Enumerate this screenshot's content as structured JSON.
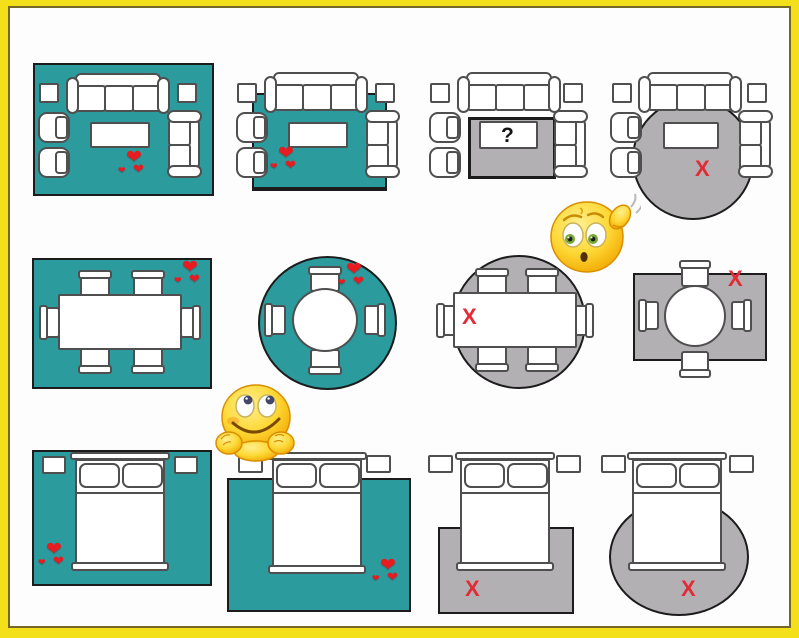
{
  "title": "rug-size-and-placement-guide",
  "marks": {
    "heart": "❤",
    "x": "X",
    "question": "?"
  },
  "colors": {
    "frame_yellow": "#f4e01a",
    "frame_inner_line": "#756827",
    "background": "#fdfdfd",
    "rug_correct_teal": "#2b9b9d",
    "rug_wrong_gray": "#b3b0b3",
    "furniture_outline": "#4f4f4f",
    "rug_outline": "#1c1c1c",
    "heart_red": "#e81c20",
    "x_red": "#e22b35",
    "question_black": "#141414",
    "emoji_yellow": "#fdd835"
  },
  "grid": {
    "rows": [
      {
        "room": "living-room",
        "panels": [
          {
            "rug": "large-rect-teal-all-furniture-on",
            "verdict": "good",
            "mark": "hearts"
          },
          {
            "rug": "rect-teal-front-legs-on",
            "verdict": "good",
            "mark": "hearts"
          },
          {
            "rug": "tiny-gray-under-coffee-table-only",
            "verdict": "uncertain",
            "mark": "question"
          },
          {
            "rug": "round-gray-under-seating",
            "verdict": "bad",
            "mark": "x"
          }
        ]
      },
      {
        "room": "dining-room",
        "panels": [
          {
            "rug": "rect-teal-table-and-chairs-on",
            "verdict": "good",
            "mark": "hearts"
          },
          {
            "rug": "round-teal-round-table",
            "verdict": "good",
            "mark": "hearts"
          },
          {
            "rug": "round-gray-rect-table-chairs-off",
            "verdict": "bad",
            "mark": "x"
          },
          {
            "rug": "small-rect-gray-chairs-off",
            "verdict": "bad",
            "mark": "x"
          }
        ]
      },
      {
        "room": "bedroom",
        "panels": [
          {
            "rug": "large-rect-teal-whole-bed-on",
            "verdict": "good",
            "mark": "hearts"
          },
          {
            "rug": "rect-teal-two-thirds-under-bed",
            "verdict": "good",
            "mark": "hearts"
          },
          {
            "rug": "small-rect-gray-at-foot-only",
            "verdict": "bad",
            "mark": "x"
          },
          {
            "rug": "round-gray-at-foot-only",
            "verdict": "bad",
            "mark": "x"
          }
        ]
      }
    ]
  },
  "emojis": [
    {
      "name": "confused-scratching-head-emoji"
    },
    {
      "name": "daydreaming-hands-on-chin-emoji"
    }
  ]
}
